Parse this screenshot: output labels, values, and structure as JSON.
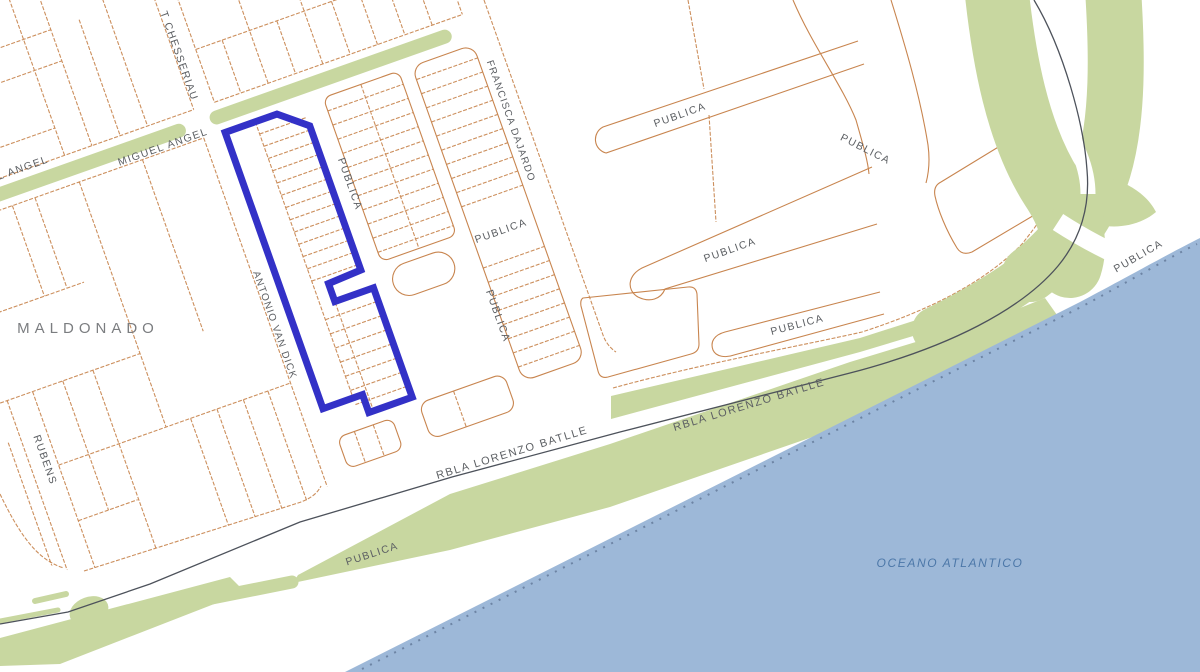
{
  "map": {
    "region_label": "MALDONADO",
    "water_label": "OCEANO ATLANTICO",
    "street_names": {
      "miguel_angel": "MIGUEL ANGEL",
      "miguel_angel_partial": "L ANGEL",
      "t_chesseriau": "T CHESSERIAU",
      "francisca_dajardo": "FRANCISCA DAJARDO",
      "antonio_van_dick": "ANTONIO VAN DICK",
      "rubens": "RUBENS",
      "rambla": "RBLA LORENZO BATLLE",
      "publica": "PUBLICA"
    },
    "colors": {
      "selection_outline": "#3331c7",
      "parcel_line": "#c8854f",
      "greenspace": "#c8d7a0",
      "water": "#9db8d8",
      "road_centerline": "#4d525b",
      "label_gray": "#5c5f63"
    }
  },
  "labels": [
    {
      "id": "miguel-angel",
      "text": "MIGUEL ANGEL"
    },
    {
      "id": "l-angel",
      "text": "L ANGEL"
    },
    {
      "id": "t-chesseriau",
      "text": "T CHESSERIAU"
    },
    {
      "id": "francisca-dajardo",
      "text": "FRANCISCA DAJARDO"
    },
    {
      "id": "antonio-van-dick",
      "text": "ANTONIO VAN DICK"
    },
    {
      "id": "rubens",
      "text": "RUBENS"
    },
    {
      "id": "maldonado",
      "text": "MALDONADO"
    },
    {
      "id": "publica-1",
      "text": "PUBLICA"
    },
    {
      "id": "publica-2",
      "text": "PUBLICA"
    },
    {
      "id": "publica-3",
      "text": "PUBLICA"
    },
    {
      "id": "publica-4",
      "text": "PUBLICA"
    },
    {
      "id": "publica-5",
      "text": "PUBLICA"
    },
    {
      "id": "publica-6",
      "text": "PUBLICA"
    },
    {
      "id": "publica-7",
      "text": "PUBLICA"
    },
    {
      "id": "publica-8",
      "text": "PUBLICA"
    },
    {
      "id": "publica-9",
      "text": "PUBLICA"
    },
    {
      "id": "rbla-1",
      "text": "RBLA LORENZO BATLLE"
    },
    {
      "id": "rbla-2",
      "text": "RBLA LORENZO BATLLE"
    },
    {
      "id": "oceano-atlantico",
      "text": "OCEANO ATLANTICO"
    }
  ]
}
